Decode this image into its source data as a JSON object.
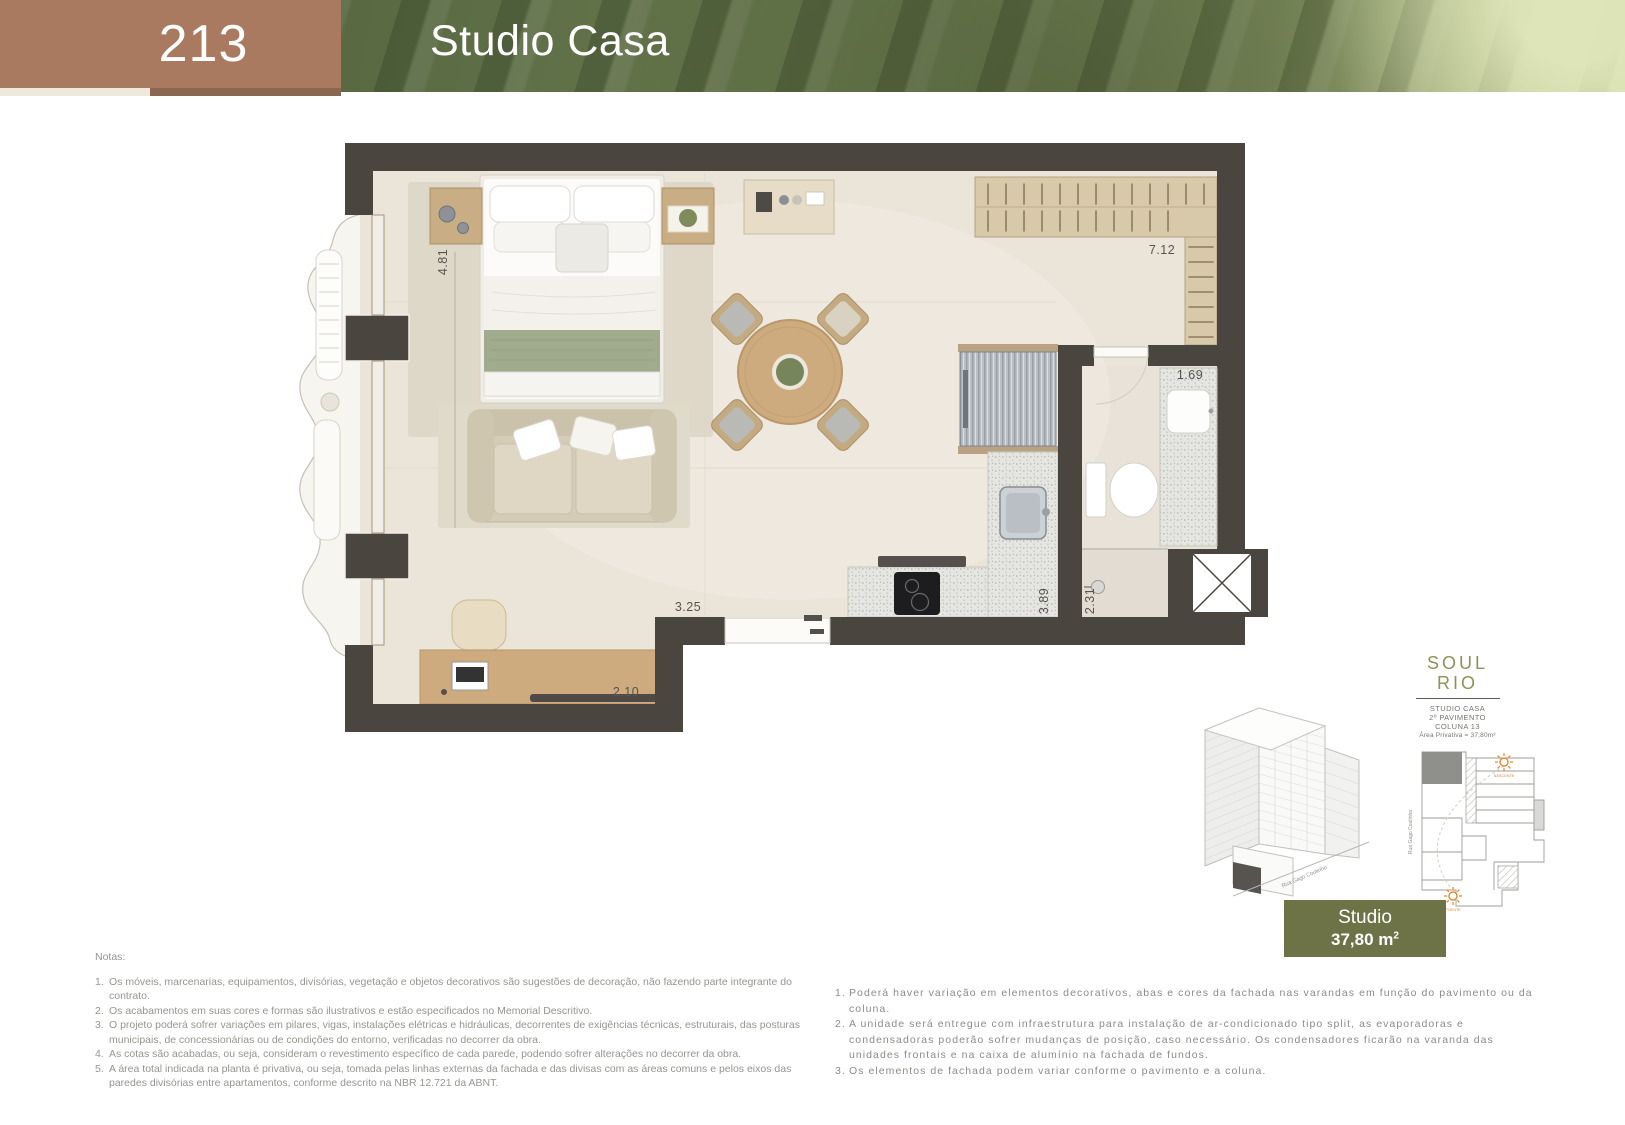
{
  "header": {
    "unit_number": "213",
    "title": "Studio Casa"
  },
  "plan": {
    "dim_bedroom": "4.81",
    "dim_closet": "7.12",
    "dim_bath_counter": "1.69",
    "dim_living": "3.25",
    "dim_kitchen": "3.89",
    "dim_shower": "2.31",
    "dim_desk": "2.10"
  },
  "building": {
    "street": "Rua Gago Coutinho"
  },
  "keyplan": {
    "street": "Rua Gago Coutinho",
    "sun_rise": "NASCENTE",
    "sun_set": "POENTE"
  },
  "logo": {
    "word_top": "SOUL",
    "word_bottom": "RIO",
    "caption_line1": "STUDIO CASA",
    "caption_line2": "2º PAVIMENTO",
    "caption_line3": "COLUNA 13",
    "caption_line4": "Área Privativa = 37,80m²"
  },
  "badge": {
    "label": "Studio",
    "area": "37,80 m",
    "area_sup": "2"
  },
  "notes_left": {
    "heading": "Notas:",
    "items": [
      "Os móveis, marcenarias, equipamentos, divisórias, vegetação e objetos decorativos são sugestões de decoração, não fazendo parte integrante do contrato.",
      "Os acabamentos em suas cores e formas são ilustrativos e estão especificados no Memorial Descritivo.",
      "O projeto poderá sofrer variações em pilares, vigas, instalações elétricas e hidráulicas, decorrentes de exigências técnicas, estruturais, das posturas municipais, de concessionárias ou de condições do entorno, verificadas no decorrer da obra.",
      "As cotas são acabadas, ou seja, consideram o revestimento específico de cada parede, podendo sofrer alterações no decorrer da obra.",
      "A área total indicada na planta é privativa, ou seja, tomada pelas linhas externas da fachada e das divisas com as áreas comuns e pelos eixos das paredes divisórias entre apartamentos, conforme descrito na NBR 12.721 da ABNT."
    ]
  },
  "notes_right": {
    "items": [
      "Poderá haver variação em elementos decorativos, abas e cores da fachada nas varandas em função do pavimento ou da coluna.",
      "A unidade será entregue com infraestrutura para instalação de ar-condicionado tipo split, as evaporadoras e condensadoras poderão sofrer mudanças de posição, caso necessário. Os condensadores ficarão na varanda das unidades frontais e na caixa de alumínio na fachada de fundos.",
      "Os elementos de fachada podem variar conforme o pavimento e a coluna."
    ]
  },
  "colors": {
    "accent_brown": "#a97a60",
    "accent_olive": "#6d7347",
    "logo_olive": "#8f9257",
    "sun_orange": "#e8872d",
    "wall_dark": "#4b4540"
  }
}
